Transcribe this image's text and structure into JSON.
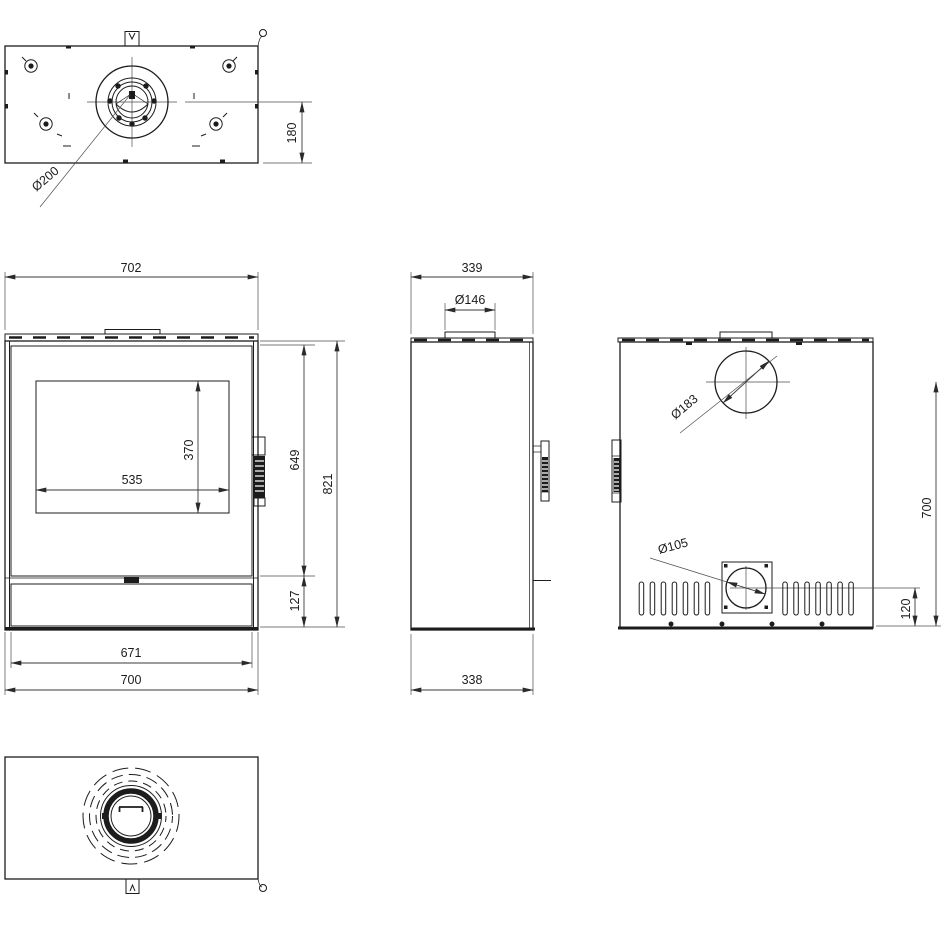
{
  "drawing_title": "Stove dimensional drawing",
  "colors": {
    "line": "#1c1c1c",
    "dim_line": "#3a3a3a",
    "thin_line": "#4f4f4f",
    "background": "#ffffff"
  },
  "views": {
    "top": {
      "dims": {
        "flue_center_to_front": "180",
        "flue_diameter": "Ø200"
      }
    },
    "front": {
      "dims": {
        "width_overall": "702",
        "glass_width": "535",
        "glass_height": "370",
        "door_height": "649",
        "overall_height": "821",
        "plinth_height": "127",
        "inner_width": "671",
        "base_width": "700"
      }
    },
    "side": {
      "dims": {
        "depth_overall": "339",
        "collar_diameter": "Ø146",
        "base_depth": "338"
      }
    },
    "rear": {
      "dims": {
        "flue_diameter": "Ø183",
        "flue_center_height": "700",
        "intake_diameter": "Ø105",
        "intake_center_height": "120"
      }
    },
    "bottom": {
      "dims": {}
    }
  }
}
